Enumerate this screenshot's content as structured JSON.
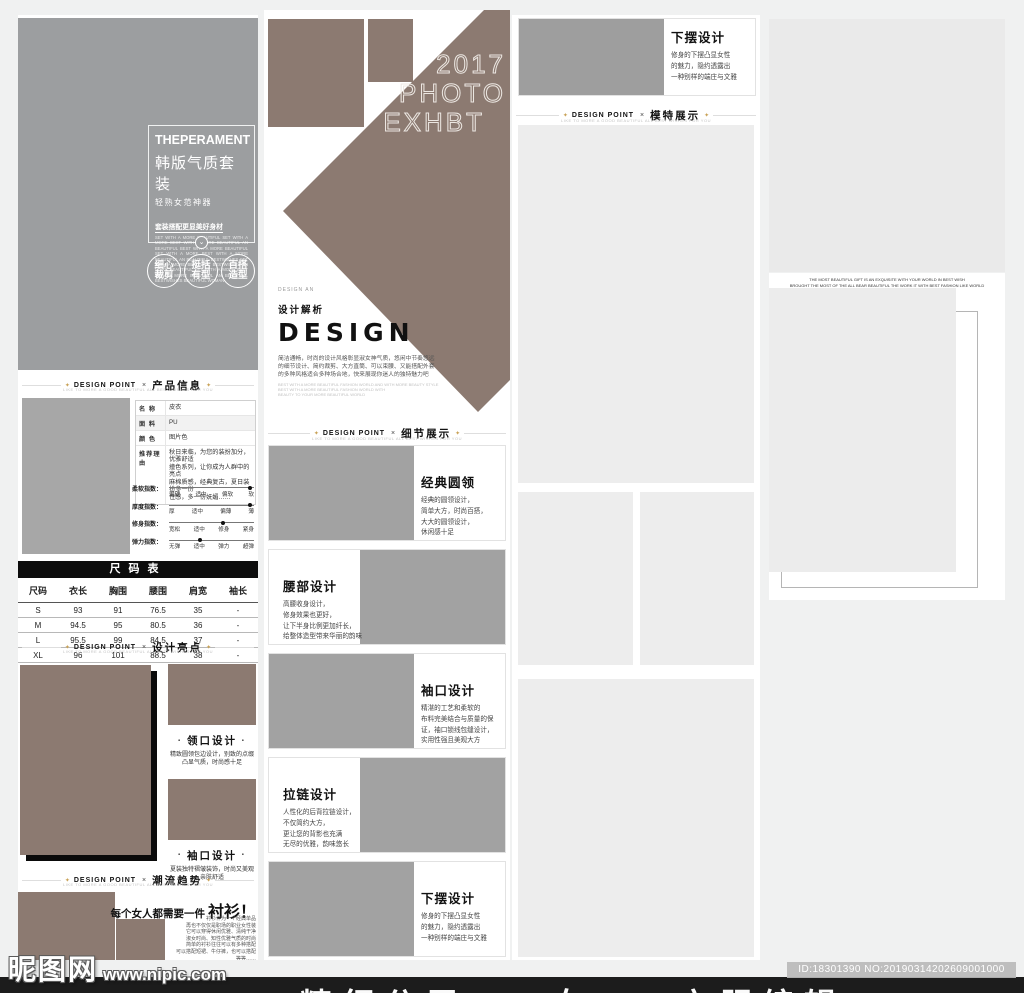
{
  "ui": {
    "diamond": "✦",
    "dot": "•"
  },
  "page": {
    "watermark_logo": "昵图网",
    "watermark_url": "www.nipic.com",
    "footer_banner": "精细分层——女——衣服编辑",
    "id_badge": "ID:18301390 NO:20190314202609001000"
  },
  "col1": {
    "hero": {
      "brand": "THEPERAMENT",
      "title": "韩版气质套装",
      "subtitle": "轻熟女范神器",
      "slogan": "套装搭配更显美好身材",
      "fineprint": "SET WITH A MORE BEAUTIFUL SET WITH A MORE BEST WITH A MORE BEAUTIFUL AN BEAUTIFUL BEST WITH A MORE BEAUTIFUL SET WITH A MORE BEST WITH A MORE BEAUTIFUL AN BEAUTIFUL BESTWISHES SET WITH A MORE BEAUTIFUL BESTWISHES AN MORE BEAUTIFUL SET WITH A MORE BEST WITH A MORE BEAUTIFUL AN BEAUTIFUL BESTWISHES BEAUTIFUL WOMAN",
      "chevron": "⌄",
      "badges": [
        "细心\n裁剪",
        "挺括\n有型",
        "百搭\n造型"
      ]
    },
    "div1": {
      "label": "DESIGN POINT",
      "sep": "×",
      "title": "产品信息",
      "sub": "LIKE TO MORE A GOOD BEAUTIFUL ALL BEST WISHES FOR YOU"
    },
    "product_info": {
      "rows": [
        {
          "label": "名 称",
          "value": "皮衣"
        },
        {
          "label": "面 料",
          "value": "PU"
        },
        {
          "label": "颜 色",
          "value": "图片色"
        },
        {
          "label": "推荐理由",
          "value": "秋日来临，为您的装扮加分，优雅舒适\n撞色系列，让你成为人群中的亮点\n麻棉质感，经典复古，夏日装扮多一份\n性感，多一份妩媚……"
        }
      ],
      "sliders": [
        {
          "label": "柔软指数：",
          "ticks": [
            "偏硬",
            "适中",
            "偏软",
            "软"
          ],
          "pos": 0.95
        },
        {
          "label": "厚度指数：",
          "ticks": [
            "厚",
            "适中",
            "偏薄",
            "薄"
          ],
          "pos": 0.95
        },
        {
          "label": "修身指数：",
          "ticks": [
            "宽松",
            "适中",
            "修身",
            "紧身"
          ],
          "pos": 0.63
        },
        {
          "label": "弹力指数：",
          "ticks": [
            "无弹",
            "适中",
            "弹力",
            "超弹"
          ],
          "pos": 0.37
        }
      ]
    },
    "size_table": {
      "title": "尺码表",
      "headers": [
        "尺码",
        "衣长",
        "胸围",
        "腰围",
        "肩宽",
        "袖长"
      ],
      "rows": [
        [
          "S",
          "93",
          "91",
          "76.5",
          "35",
          "-"
        ],
        [
          "M",
          "94.5",
          "95",
          "80.5",
          "36",
          "-"
        ],
        [
          "L",
          "95.5",
          "99",
          "84.5",
          "37",
          "-"
        ],
        [
          "XL",
          "96",
          "101",
          "88.5",
          "38",
          "-"
        ]
      ]
    },
    "div2": {
      "label": "DESIGN POINT",
      "sep": "×",
      "title": "设计亮点",
      "sub": "LIKE TO MORE A GOOD BEAUTIFUL ALL BEST WISHES FOR YOU"
    },
    "highlights": [
      {
        "title": "领口设计",
        "desc": "精致圆领包边设计，别致的点缀\n凸显气质，时尚感十足"
      },
      {
        "title": "袖口设计",
        "desc": "夏装独特褶皱装饰，时尚又美观\n亲肤舒适"
      }
    ],
    "div3": {
      "label": "DESIGN POINT",
      "sep": "×",
      "title": "潮流趋势",
      "sub": "LIKE TO MORE A GOOD BEAUTIFUL ALL BEST WISHES FOR YOU"
    },
    "trend": {
      "headline": "每个女人都需要一件",
      "headline_big": "衬衫！",
      "paragraph": "衬衫作为一个经典单品\n再也不仅仅是职场的职业女性装\n它可以穿得休闲优雅、清纯干净\n淑女时尚、知性优雅气质的时尚\n简单的衬衫往往可以有多种搭配\n可以搭配短裙、牛仔裤，也可以搭配\n等等……"
    }
  },
  "col2": {
    "poster": {
      "year": "2017",
      "line2": "PHOTO",
      "line3": "EXHBT",
      "caption": "DESIGN AN",
      "subtitle": "设计解析",
      "title": "DESIGN",
      "body": "简洁通畅，时尚的设计风格彰显淑女神气质，悠闲中节奏悠远\n的细节设计、简约裁剪、大方直筒、可以束腰、又能搭配外套\n的多种风格适合多种场合地，快来展现你迷人的独特魅力吧",
      "fine": "BEST WITH A MORE BEAUTIFUL FASHION WORLD AND WITH MORE BEAUTY STYLE\nBEST WITH A MORE BEAUTIFUL FASHION WORLD WITH\nBEAUTY TO YOUR MORE BEAUTIFUL WORLD"
    },
    "div4": {
      "label": "DESIGN POINT",
      "sep": "×",
      "title": "细节展示",
      "sub": "LIKE TO MORE A GOOD BEAUTIFUL ALL BEST WISHES FOR YOU"
    },
    "cards": [
      {
        "title": "经典圆领",
        "lines": "经典的圆领设计，\n简单大方，时尚百搭，\n大大的圆领设计，\n休闲感十足"
      },
      {
        "title": "腰部设计",
        "lines": "高腰收身设计，\n修身效果也更好，\n让下半身比例更加纤长，\n给整体造型带来华丽的韵味"
      },
      {
        "title": "袖口设计",
        "lines": "精湛的工艺和柔软的\n布料完美结合与质量的保\n证，袖口锁线包缝设计，\n实用性强且美观大方"
      },
      {
        "title": "拉链设计",
        "lines": "人性化的后背拉链设计，\n不仅简约大方，\n更让您的背影也充满\n无尽的优雅，韵味悠长"
      },
      {
        "title": "下摆设计",
        "lines": "修身的下摆凸显女性\n的魅力，隐约透露出\n一种别样的端庄与文雅"
      }
    ]
  },
  "col3": {
    "card": {
      "title": "下摆设计",
      "lines": "修身的下摆凸显女性\n的魅力，隐约透露出\n一种别样的端庄与文雅"
    },
    "div5": {
      "label": "DESIGN POINT",
      "sep": "×",
      "title": "模特展示",
      "sub": "LIKE TO MORE A GOOD BEAUTIFUL ALL BEST WISHES FOR YOU"
    }
  },
  "col4": {
    "note1": "THE MOST BEAUTIFUL GIFT IS AN EXQUISITE WITH YOUR WORLD IN BEST WISH",
    "note2": "BROUGHT THE MOST OF THE ALL BEAR BEAUTIFUL THE WORK IT WITH BEST FASHION LIKE WORLD"
  }
}
